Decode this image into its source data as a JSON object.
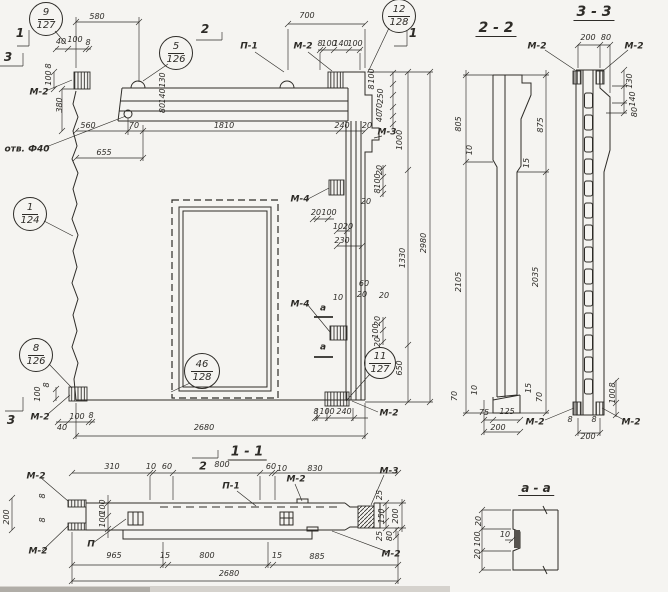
{
  "page": {
    "background": "#f5f4f1",
    "ink": "#2e2c28",
    "description_visible_views": [
      "main panel elevation",
      "2 - 2",
      "3 - 3",
      "1 - 1",
      "a - a"
    ]
  },
  "callouts": [
    {
      "n": "callout-9-127",
      "top": "9",
      "bottom": "127",
      "cx": 46,
      "cy": 19,
      "r": 17
    },
    {
      "n": "callout-5-126",
      "top": "5",
      "bottom": "126",
      "cx": 176,
      "cy": 53,
      "r": 17
    },
    {
      "n": "callout-12-128",
      "top": "12",
      "bottom": "128",
      "cx": 399,
      "cy": 16,
      "r": 17
    },
    {
      "n": "callout-1-124",
      "top": "1",
      "bottom": "124",
      "cx": 30,
      "cy": 214,
      "r": 17
    },
    {
      "n": "callout-8-126",
      "top": "8",
      "bottom": "126",
      "cx": 36,
      "cy": 355,
      "r": 17
    },
    {
      "n": "callout-46-128",
      "top": "46",
      "bottom": "128",
      "cx": 202,
      "cy": 371,
      "r": 18
    },
    {
      "n": "callout-11-127",
      "top": "11",
      "bottom": "127",
      "cx": 380,
      "cy": 363,
      "r": 16
    }
  ],
  "texts": [
    {
      "n": "section-marker-1-topleft",
      "t": "1",
      "x": 20,
      "y": 33,
      "s": 12,
      "c": "mark"
    },
    {
      "n": "section-marker-3-topleft",
      "t": "3",
      "x": 8,
      "y": 57,
      "s": 12,
      "c": "mark"
    },
    {
      "n": "section-marker-2-top",
      "t": "2",
      "x": 205,
      "y": 29,
      "s": 12,
      "c": "mark"
    },
    {
      "n": "section-marker-1-topright",
      "t": "1",
      "x": 413,
      "y": 33,
      "s": 12,
      "c": "mark"
    },
    {
      "n": "section-marker-3-bottomleft",
      "t": "3",
      "x": 11,
      "y": 420,
      "s": 12,
      "c": "mark"
    },
    {
      "n": "section-marker-2-bottom",
      "t": "2",
      "x": 203,
      "y": 466,
      "s": 11,
      "c": "mark"
    },
    {
      "n": "view-title-1-1",
      "t": "1 - 1",
      "x": 247,
      "y": 453,
      "s": 13,
      "c": "hdr"
    },
    {
      "n": "view-title-2-2",
      "t": "2 - 2",
      "x": 496,
      "y": 29,
      "s": 14,
      "c": "hdr"
    },
    {
      "n": "view-title-3-3",
      "t": "3 - 3",
      "x": 594,
      "y": 13,
      "s": 14,
      "c": "hdr"
    },
    {
      "n": "view-title-a-a",
      "t": "a - a",
      "x": 536,
      "y": 489,
      "s": 12,
      "c": "hdr"
    },
    {
      "n": "dim",
      "t": "580",
      "x": 97,
      "y": 17
    },
    {
      "n": "dim",
      "t": "40",
      "x": 61,
      "y": 42
    },
    {
      "n": "dim",
      "t": "100",
      "x": 75,
      "y": 40
    },
    {
      "n": "dim",
      "t": "8",
      "x": 88,
      "y": 43
    },
    {
      "n": "dim",
      "t": "8",
      "x": 49,
      "y": 66,
      "r": true
    },
    {
      "n": "dim",
      "t": "100",
      "x": 49,
      "y": 78,
      "r": true
    },
    {
      "n": "embed-label",
      "t": "М-2",
      "x": 39,
      "y": 93,
      "c": "label"
    },
    {
      "n": "dim",
      "t": "380",
      "x": 60,
      "y": 105,
      "r": true
    },
    {
      "n": "dim",
      "t": "130",
      "x": 163,
      "y": 80,
      "r": true
    },
    {
      "n": "dim",
      "t": "140",
      "x": 163,
      "y": 96,
      "r": true
    },
    {
      "n": "dim",
      "t": "80",
      "x": 163,
      "y": 108,
      "r": true
    },
    {
      "n": "dim",
      "t": "560",
      "x": 88,
      "y": 126
    },
    {
      "n": "dim",
      "t": "70",
      "x": 134,
      "y": 126
    },
    {
      "n": "dim",
      "t": "655",
      "x": 104,
      "y": 153
    },
    {
      "n": "hole-label",
      "t": "отв. Ф40",
      "x": 27,
      "y": 150,
      "c": "label"
    },
    {
      "n": "dim",
      "t": "1810",
      "x": 224,
      "y": 126
    },
    {
      "n": "dim",
      "t": "240",
      "x": 342,
      "y": 126
    },
    {
      "n": "part-label",
      "t": "П-1",
      "x": 249,
      "y": 47,
      "c": "label"
    },
    {
      "n": "embed-label",
      "t": "М-2",
      "x": 303,
      "y": 47,
      "c": "label"
    },
    {
      "n": "dim",
      "t": "8",
      "x": 320,
      "y": 44
    },
    {
      "n": "dim",
      "t": "100",
      "x": 329,
      "y": 44
    },
    {
      "n": "dim",
      "t": "140",
      "x": 341,
      "y": 44
    },
    {
      "n": "dim",
      "t": "100",
      "x": 355,
      "y": 44
    },
    {
      "n": "dim",
      "t": "700",
      "x": 307,
      "y": 16
    },
    {
      "n": "dim",
      "t": "100",
      "x": 372,
      "y": 76,
      "r": true
    },
    {
      "n": "dim",
      "t": "8",
      "x": 372,
      "y": 87,
      "r": true
    },
    {
      "n": "dim",
      "t": "250",
      "x": 381,
      "y": 96,
      "r": true
    },
    {
      "n": "dim",
      "t": "70",
      "x": 380,
      "y": 108,
      "r": true
    },
    {
      "n": "dim",
      "t": "40",
      "x": 380,
      "y": 117,
      "r": true
    },
    {
      "n": "dim",
      "t": "20",
      "x": 367,
      "y": 126
    },
    {
      "n": "embed-label",
      "t": "М-3",
      "x": 387,
      "y": 133,
      "c": "label"
    },
    {
      "n": "dim",
      "t": "1000",
      "x": 400,
      "y": 140,
      "r": true
    },
    {
      "n": "dim",
      "t": "2980",
      "x": 424,
      "y": 243,
      "r": true
    },
    {
      "n": "dim",
      "t": "1330",
      "x": 403,
      "y": 258,
      "r": true
    },
    {
      "n": "dim",
      "t": "650",
      "x": 400,
      "y": 368,
      "r": true
    },
    {
      "n": "embed-label",
      "t": "М-4",
      "x": 300,
      "y": 200,
      "c": "label"
    },
    {
      "n": "dim",
      "t": "20",
      "x": 316,
      "y": 213
    },
    {
      "n": "dim",
      "t": "100",
      "x": 329,
      "y": 213
    },
    {
      "n": "dim",
      "t": "10",
      "x": 338,
      "y": 227
    },
    {
      "n": "dim",
      "t": "20",
      "x": 348,
      "y": 227
    },
    {
      "n": "dim",
      "t": "230",
      "x": 342,
      "y": 241
    },
    {
      "n": "dim",
      "t": "20",
      "x": 380,
      "y": 170,
      "r": true
    },
    {
      "n": "dim",
      "t": "100",
      "x": 378,
      "y": 181,
      "r": true
    },
    {
      "n": "dim",
      "t": "8",
      "x": 378,
      "y": 191,
      "r": true
    },
    {
      "n": "dim",
      "t": "20",
      "x": 366,
      "y": 202
    },
    {
      "n": "dim",
      "t": "10",
      "x": 338,
      "y": 298
    },
    {
      "n": "dim",
      "t": "60",
      "x": 364,
      "y": 284
    },
    {
      "n": "dim",
      "t": "20",
      "x": 362,
      "y": 295
    },
    {
      "n": "dim",
      "t": "20",
      "x": 384,
      "y": 296
    },
    {
      "n": "embed-label",
      "t": "М-4",
      "x": 300,
      "y": 305,
      "c": "label"
    },
    {
      "n": "section-letter",
      "t": "a",
      "x": 323,
      "y": 309,
      "c": "label"
    },
    {
      "n": "section-letter",
      "t": "a",
      "x": 323,
      "y": 348,
      "c": "label"
    },
    {
      "n": "dim",
      "t": "20",
      "x": 378,
      "y": 321,
      "r": true
    },
    {
      "n": "dim",
      "t": "100",
      "x": 376,
      "y": 331,
      "r": true
    },
    {
      "n": "dim",
      "t": "20",
      "x": 378,
      "y": 342,
      "r": true
    },
    {
      "n": "dim",
      "t": "8",
      "x": 316,
      "y": 412
    },
    {
      "n": "dim",
      "t": "100",
      "x": 327,
      "y": 412
    },
    {
      "n": "dim",
      "t": "240",
      "x": 344,
      "y": 412
    },
    {
      "n": "embed-label",
      "t": "М-2",
      "x": 389,
      "y": 414,
      "c": "label"
    },
    {
      "n": "embed-label",
      "t": "М-2",
      "x": 40,
      "y": 418,
      "c": "label"
    },
    {
      "n": "dim",
      "t": "8",
      "x": 47,
      "y": 385,
      "r": true
    },
    {
      "n": "dim",
      "t": "100",
      "x": 38,
      "y": 394,
      "r": true
    },
    {
      "n": "dim",
      "t": "40",
      "x": 62,
      "y": 428
    },
    {
      "n": "dim",
      "t": "100",
      "x": 77,
      "y": 417
    },
    {
      "n": "dim",
      "t": "8",
      "x": 91,
      "y": 416
    },
    {
      "n": "dim",
      "t": "2680",
      "x": 204,
      "y": 428
    },
    {
      "n": "dim",
      "t": "805",
      "x": 459,
      "y": 124,
      "r": true
    },
    {
      "n": "dim",
      "t": "875",
      "x": 541,
      "y": 125,
      "r": true
    },
    {
      "n": "dim",
      "t": "10",
      "x": 470,
      "y": 150,
      "r": true
    },
    {
      "n": "dim",
      "t": "15",
      "x": 527,
      "y": 163,
      "r": true
    },
    {
      "n": "dim",
      "t": "2105",
      "x": 459,
      "y": 282,
      "r": true
    },
    {
      "n": "dim",
      "t": "2035",
      "x": 536,
      "y": 277,
      "r": true
    },
    {
      "n": "dim",
      "t": "70",
      "x": 455,
      "y": 396,
      "r": true
    },
    {
      "n": "dim",
      "t": "10",
      "x": 475,
      "y": 390,
      "r": true
    },
    {
      "n": "dim",
      "t": "15",
      "x": 529,
      "y": 388,
      "r": true
    },
    {
      "n": "dim",
      "t": "70",
      "x": 540,
      "y": 397,
      "r": true
    },
    {
      "n": "dim",
      "t": "75",
      "x": 484,
      "y": 413
    },
    {
      "n": "dim",
      "t": "125",
      "x": 507,
      "y": 412
    },
    {
      "n": "dim",
      "t": "200",
      "x": 498,
      "y": 428
    },
    {
      "n": "dim",
      "t": "200",
      "x": 588,
      "y": 38
    },
    {
      "n": "dim",
      "t": "80",
      "x": 606,
      "y": 38
    },
    {
      "n": "embed-label",
      "t": "М-2",
      "x": 537,
      "y": 47,
      "c": "label"
    },
    {
      "n": "embed-label",
      "t": "М-2",
      "x": 634,
      "y": 47,
      "c": "label"
    },
    {
      "n": "dim",
      "t": "130",
      "x": 630,
      "y": 81,
      "r": true
    },
    {
      "n": "dim",
      "t": "140",
      "x": 633,
      "y": 99,
      "r": true
    },
    {
      "n": "dim",
      "t": "80",
      "x": 635,
      "y": 112,
      "r": true
    },
    {
      "n": "embed-label",
      "t": "М-2",
      "x": 535,
      "y": 423,
      "c": "label"
    },
    {
      "n": "embed-label",
      "t": "М-2",
      "x": 631,
      "y": 423,
      "c": "label"
    },
    {
      "n": "dim",
      "t": "8",
      "x": 570,
      "y": 420
    },
    {
      "n": "dim",
      "t": "8",
      "x": 594,
      "y": 420
    },
    {
      "n": "dim",
      "t": "200",
      "x": 588,
      "y": 437
    },
    {
      "n": "dim",
      "t": "100",
      "x": 613,
      "y": 396,
      "r": true
    },
    {
      "n": "dim",
      "t": "8",
      "x": 613,
      "y": 385,
      "r": true
    },
    {
      "n": "dim",
      "t": "20",
      "x": 479,
      "y": 521,
      "r": true
    },
    {
      "n": "dim",
      "t": "100",
      "x": 478,
      "y": 539,
      "r": true
    },
    {
      "n": "dim",
      "t": "20",
      "x": 478,
      "y": 554,
      "r": true
    },
    {
      "n": "dim",
      "t": "10",
      "x": 505,
      "y": 535
    },
    {
      "n": "embed-label",
      "t": "М-2",
      "x": 36,
      "y": 477,
      "c": "label"
    },
    {
      "n": "embed-label",
      "t": "М-2",
      "x": 38,
      "y": 552,
      "c": "label"
    },
    {
      "n": "dim",
      "t": "200",
      "x": 7,
      "y": 517,
      "r": true
    },
    {
      "n": "dim",
      "t": "8",
      "x": 43,
      "y": 496,
      "r": true
    },
    {
      "n": "dim",
      "t": "8",
      "x": 43,
      "y": 520,
      "r": true
    },
    {
      "n": "dim",
      "t": "310",
      "x": 112,
      "y": 467
    },
    {
      "n": "dim",
      "t": "10",
      "x": 151,
      "y": 467
    },
    {
      "n": "dim",
      "t": "60",
      "x": 167,
      "y": 467
    },
    {
      "n": "dim",
      "t": "800",
      "x": 222,
      "y": 465
    },
    {
      "n": "dim",
      "t": "60",
      "x": 271,
      "y": 467
    },
    {
      "n": "dim",
      "t": "10",
      "x": 282,
      "y": 469
    },
    {
      "n": "dim",
      "t": "830",
      "x": 315,
      "y": 469
    },
    {
      "n": "part-label",
      "t": "П-1",
      "x": 231,
      "y": 487,
      "c": "label"
    },
    {
      "n": "embed-label",
      "t": "М-2",
      "x": 296,
      "y": 480,
      "c": "label"
    },
    {
      "n": "embed-label",
      "t": "М-3",
      "x": 389,
      "y": 472,
      "c": "label"
    },
    {
      "n": "dim",
      "t": "25",
      "x": 380,
      "y": 495,
      "r": true
    },
    {
      "n": "dim",
      "t": "150",
      "x": 382,
      "y": 516,
      "r": true
    },
    {
      "n": "dim",
      "t": "200",
      "x": 396,
      "y": 516,
      "r": true
    },
    {
      "n": "dim",
      "t": "25",
      "x": 380,
      "y": 536,
      "r": true
    },
    {
      "n": "dim",
      "t": "80",
      "x": 390,
      "y": 536,
      "r": true
    },
    {
      "n": "embed-label",
      "t": "М-2",
      "x": 391,
      "y": 555,
      "c": "label"
    },
    {
      "n": "part-label",
      "t": "П",
      "x": 91,
      "y": 545,
      "c": "label"
    },
    {
      "n": "dim",
      "t": "100",
      "x": 103,
      "y": 507,
      "r": true
    },
    {
      "n": "dim",
      "t": "100",
      "x": 103,
      "y": 520,
      "r": true
    },
    {
      "n": "dim",
      "t": "965",
      "x": 114,
      "y": 556
    },
    {
      "n": "dim",
      "t": "15",
      "x": 165,
      "y": 556
    },
    {
      "n": "dim",
      "t": "800",
      "x": 207,
      "y": 556
    },
    {
      "n": "dim",
      "t": "15",
      "x": 277,
      "y": 556
    },
    {
      "n": "dim",
      "t": "885",
      "x": 317,
      "y": 557
    },
    {
      "n": "dim",
      "t": "2680",
      "x": 229,
      "y": 574
    }
  ]
}
